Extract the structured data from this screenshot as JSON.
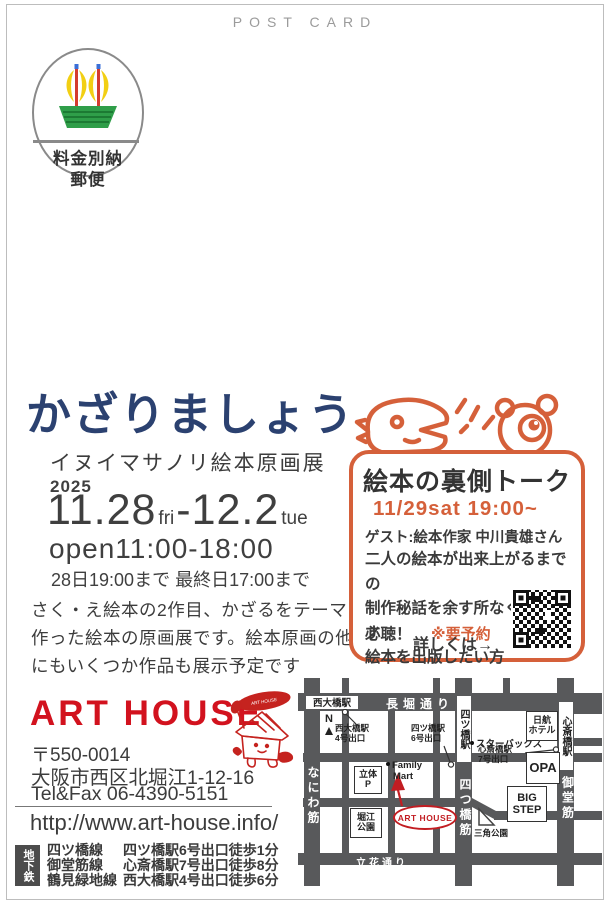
{
  "postcard_label": "POST CARD",
  "stamp": {
    "fee_line1": "料金別納",
    "fee_line2": "郵便"
  },
  "exhibition": {
    "title": "かざりましょう",
    "subtitle": "イヌイマサノリ絵本原画展",
    "year": "2025",
    "date": {
      "start_num": "11.28",
      "start_day": "fri",
      "dash": "-",
      "end_num": "12.2",
      "end_day": "tue"
    },
    "open_hours": "open11:00-18:00",
    "hours_note": "28日19:00まで 最終日17:00まで",
    "description": [
      "さく・え絵本の2作目、かざるをテーマに",
      "作った絵本の原画展です。絵本原画の他",
      "にもいくつか作品も展示予定です"
    ]
  },
  "talk": {
    "heading": "絵本の裏側トーク",
    "datetime": "11/29sat 19:00~",
    "guest": "ゲスト:絵本作家 中川貴雄さん",
    "lines": [
      "二人の絵本が出来上がるまでの",
      "制作秘話を余す所なく話します",
      "絵本を出版したい方"
    ],
    "must": "必聴！",
    "reserve": "※要予約",
    "details": "詳しくは→"
  },
  "venue": {
    "name": "ART HOUSE",
    "mascot_bubble": "ART HOUSE",
    "postal": "〒550-0014",
    "address": "大阪市西区北堀江1-12-16",
    "tel": "Tel&Fax 06-4390-5151",
    "url": "http://www.art-house.info/",
    "subway_label": "地下鉄",
    "subway": [
      {
        "line": "四ツ橋線",
        "access": "四ツ橋駅6号出口徒歩1分"
      },
      {
        "line": "御堂筋線",
        "access": "心斎橋駅7号出口徒歩8分"
      },
      {
        "line": "鶴見緑地線",
        "access": "西大橋駅4号出口徒歩6分"
      }
    ]
  },
  "map": {
    "compass": "N",
    "roads": {
      "nagahori": "長堀通り",
      "naniwa": "なにわ筋",
      "yotsubashi_suji": "四つ橋筋",
      "midosuji": "御堂筋",
      "tachibana": "立花通り"
    },
    "stations": {
      "nishiohashi": "西大橋駅",
      "yotsubashi": "四ツ橋駅",
      "shinsaibashi": "心斎橋駅"
    },
    "exits": {
      "nishiohashi": {
        "l1": "西大橋駅",
        "l2": "4号出口"
      },
      "yotsubashi": {
        "l1": "四ツ橋駅",
        "l2": "6号出口"
      },
      "shinsaibashi": {
        "l1": "心斎橋駅",
        "l2": "7号出口"
      }
    },
    "landmarks": {
      "starbucks": "スターバックス",
      "nikko_l1": "日航",
      "nikko_l2": "ホテル",
      "opa": "OPA",
      "parking_l1": "立体",
      "parking_l2": "P",
      "family_l1": "Family",
      "family_l2": "Mart",
      "horie_l1": "堀江",
      "horie_l2": "公園",
      "bigstep_l1": "BIG",
      "bigstep_l2": "STEP",
      "sankaku": "三角公園",
      "arthouse": "ART HOUSE"
    }
  },
  "colors": {
    "accent_navy": "#2b4170",
    "accent_orange": "#d5603a",
    "accent_red": "#d2121e",
    "map_road": "#58595b"
  }
}
